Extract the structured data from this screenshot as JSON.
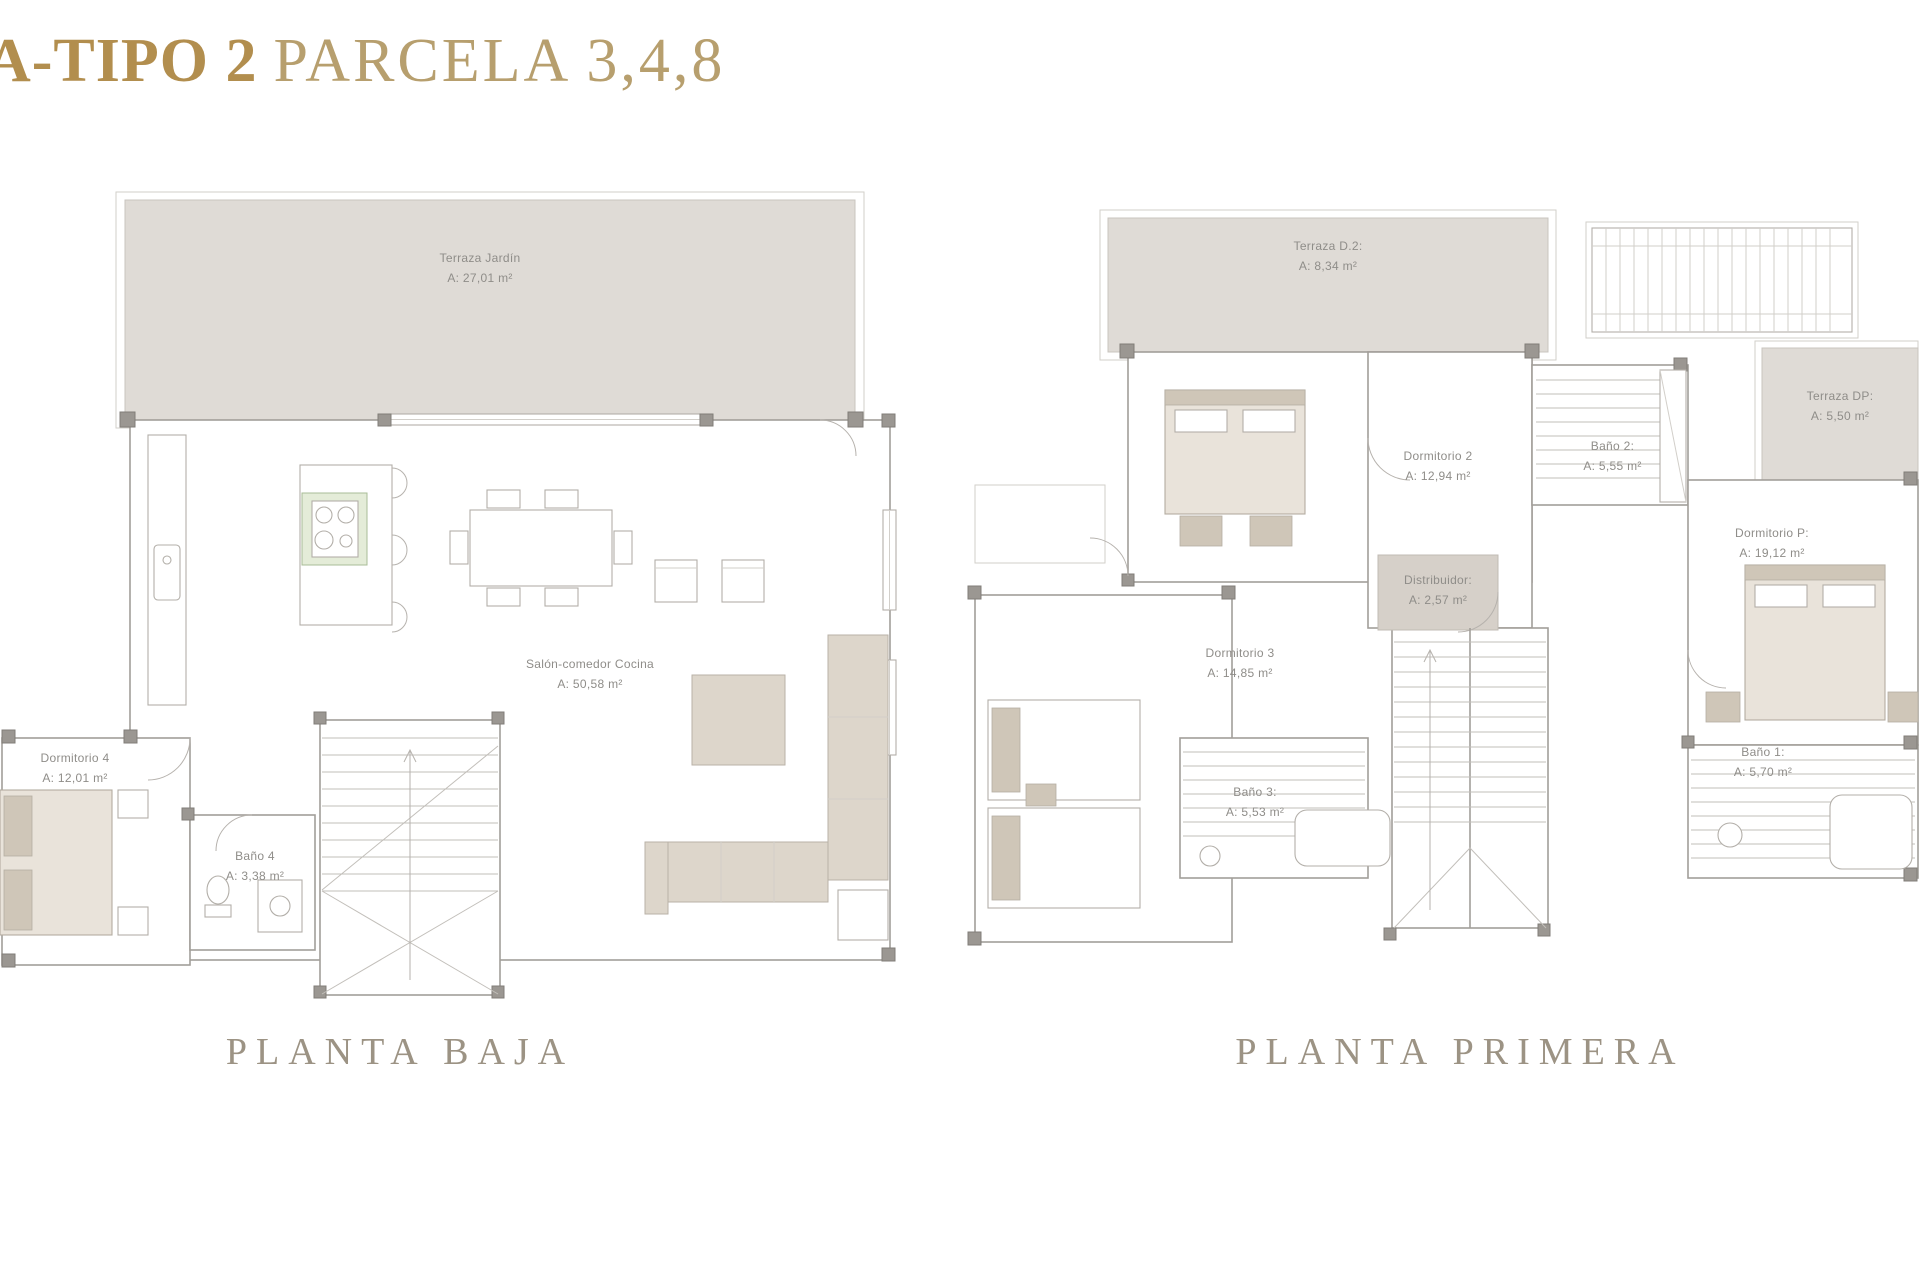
{
  "title": {
    "bold": "A-TIPO 2",
    "regular": "PARCELA 3,4,8"
  },
  "colors": {
    "title_gold": "#b28e4e",
    "title_gold_light": "#b79f6e",
    "caption": "#9c9384",
    "terrace_fill": "#dfdbd6",
    "distribuidor_fill": "#d6d0c9",
    "wall": "#a29e99",
    "furniture_beige": "#ddd6cb",
    "stove_green": "#e4ecd8",
    "label_text": "#8f8d89"
  },
  "plans": {
    "baja": {
      "caption": "PLANTA BAJA",
      "rooms": {
        "terraza_jardin": {
          "name": "Terraza  Jardín",
          "area": "A: 27,01 m²"
        },
        "salon": {
          "name": "Salón-comedor Cocina",
          "area": "A: 50,58 m²"
        },
        "dormitorio4": {
          "name": "Dormitorio 4",
          "area": "A: 12,01 m²"
        },
        "bano4": {
          "name": "Baño 4",
          "area": "A: 3,38 m²"
        }
      }
    },
    "primera": {
      "caption": "PLANTA PRIMERA",
      "rooms": {
        "terraza_d2": {
          "name": "Terraza D.2:",
          "area": "A: 8,34 m²"
        },
        "terraza_dp": {
          "name": "Terraza DP:",
          "area": "A: 5,50 m²"
        },
        "dormitorio2": {
          "name": "Dormitorio 2",
          "area": "A: 12,94 m²"
        },
        "bano2": {
          "name": "Baño 2:",
          "area": "A: 5,55 m²"
        },
        "distribuidor": {
          "name": "Distribuidor:",
          "area": "A: 2,57 m²"
        },
        "dormitorioP": {
          "name": "Dormitorio P:",
          "area": "A: 19,12 m²"
        },
        "dormitorio3": {
          "name": "Dormitorio 3",
          "area": "A: 14,85 m²"
        },
        "bano3": {
          "name": "Baño 3:",
          "area": "A: 5,53 m²"
        },
        "bano1": {
          "name": "Baño 1:",
          "area": "A: 5,70 m²"
        }
      }
    }
  }
}
